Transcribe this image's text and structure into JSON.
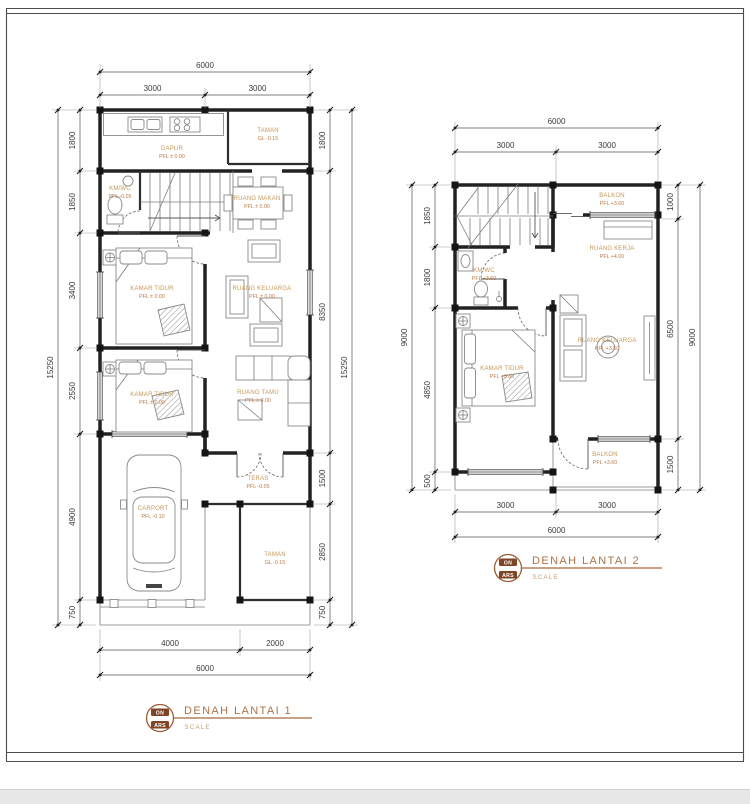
{
  "colors": {
    "accent_tan": "#ad7347",
    "label_tan": "#c59859",
    "level_orange": "#bd7a45",
    "wall": "#222222"
  },
  "plan1": {
    "title": "DENAH LANTAI 1",
    "scale_label": "SCALE",
    "logo": {
      "top": "ON",
      "bottom": "ARS"
    },
    "dims": {
      "top_total": "6000",
      "top_segments": [
        "3000",
        "3000"
      ],
      "left_segments": [
        "1800",
        "1850",
        "3400",
        "2550",
        "4900",
        "750"
      ],
      "left_total": "15250",
      "right_segments": [
        "1800",
        "8350",
        "1500",
        "2850",
        "750"
      ],
      "right_total": "15250",
      "bottom_segments": [
        "4000",
        "2000"
      ],
      "bottom_total": "6000"
    },
    "rooms": {
      "dapur": {
        "name": "DAPUR",
        "level": "PFL ± 0.00"
      },
      "taman_belakang": {
        "name": "TAMAN",
        "level": "GL -0.15"
      },
      "kmwc": {
        "name": "KM/WC",
        "level": "PFL -0.05"
      },
      "ruang_makan": {
        "name": "RUANG MAKAN",
        "level": "PFL ± 0.00"
      },
      "kamar_tidur_1": {
        "name": "KAMAR TIDUR",
        "level": "PFL ± 0.00"
      },
      "ruang_keluarga": {
        "name": "RUANG KELUARGA",
        "level": "PFL ± 0.00"
      },
      "kamar_tidur_2": {
        "name": "KAMAR TIDUR",
        "level": "PFL ± 0.00"
      },
      "ruang_tamu": {
        "name": "RUANG TAMU",
        "level": "PFL ± 0.00"
      },
      "teras": {
        "name": "TERAS",
        "level": "PFL -0.05"
      },
      "carport": {
        "name": "CARPORT",
        "level": "PFL -0.10"
      },
      "taman_depan": {
        "name": "TAMAN",
        "level": "GL -0.15"
      }
    }
  },
  "plan2": {
    "title": "DENAH LANTAI 2",
    "scale_label": "SCALE",
    "logo": {
      "top": "ON",
      "bottom": "ARS"
    },
    "dims": {
      "top_total": "6000",
      "top_segments": [
        "3000",
        "3000"
      ],
      "left_segments": [
        "1850",
        "1800",
        "4850",
        "500"
      ],
      "left_total": "9000",
      "right_segments": [
        "1000",
        "6500",
        "1500"
      ],
      "right_total": "9000",
      "bottom_segments": [
        "3000",
        "3000"
      ],
      "bottom_total": "6000"
    },
    "rooms": {
      "balkon_atas": {
        "name": "BALKON",
        "level": "PFL +3.60"
      },
      "ruang_kerja": {
        "name": "RUANG KERJA",
        "level": "PFL +4.00"
      },
      "kmwc": {
        "name": "KM/WC",
        "level": "PFL +3.60"
      },
      "kamar_tidur": {
        "name": "KAMAR TIDUR",
        "level": "PFL +3.60"
      },
      "ruang_keluarga": {
        "name": "RUANG KELUARGA",
        "level": "PFL +3.60"
      },
      "balkon_bawah": {
        "name": "BALKON",
        "level": "PFL +3.60"
      }
    }
  }
}
